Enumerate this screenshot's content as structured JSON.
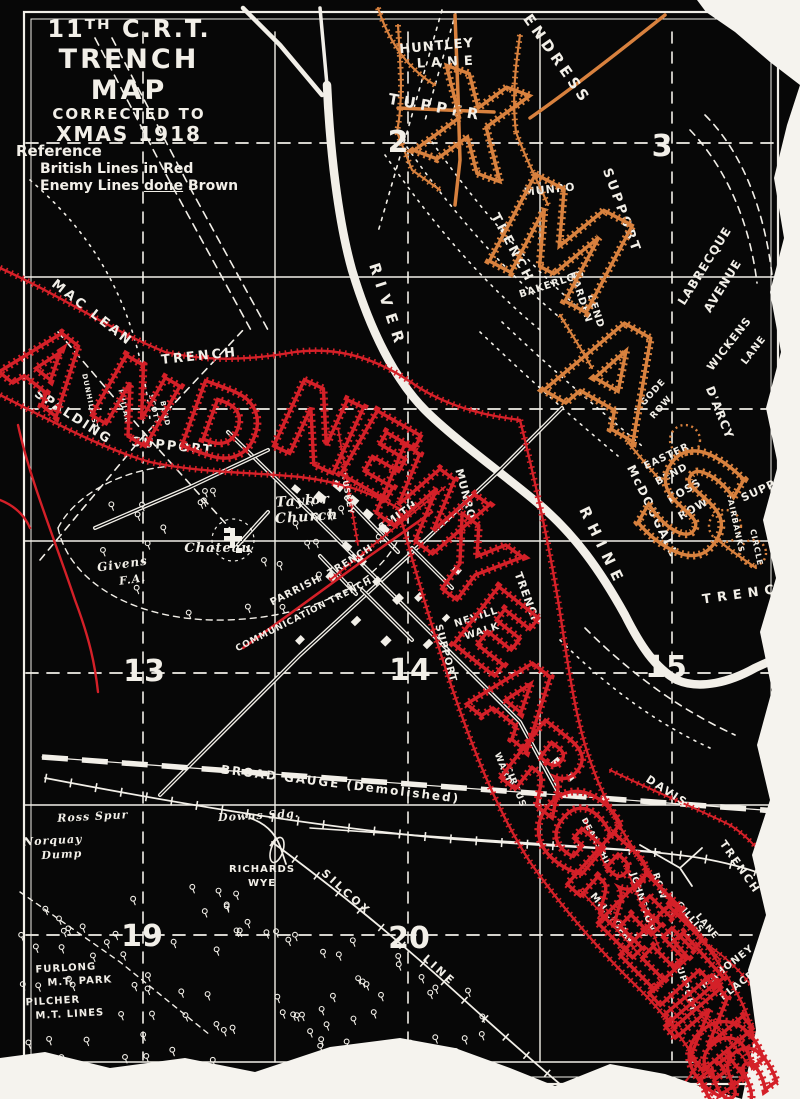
{
  "map_title": {
    "line1": "11ᵀᴴ C.R.T.",
    "line2": "TRENCH MAP",
    "line3": "CORRECTED TO",
    "line4": "XMAS 1918"
  },
  "reference": {
    "heading": "Reference",
    "british_line": "British Lines in Red",
    "enemy_pre": "Enemy Lines ",
    "enemy_underlined": "done",
    "enemy_post": " Brown"
  },
  "colors": {
    "british_red": "#d42028",
    "enemy_brown": "#d8813e",
    "map_black": "#070707",
    "line_white": "#f2efe8",
    "paper_white": "#f5f3ee"
  },
  "greetings": {
    "red_text": "AND NEW YEAR GREETINGS",
    "brown_text": "XMAS"
  },
  "big_letters": [
    {
      "ch": "A",
      "x": 48,
      "y": 368,
      "r": 38,
      "s": 95,
      "c": "red"
    },
    {
      "ch": "N",
      "x": 135,
      "y": 402,
      "r": 30,
      "s": 95,
      "c": "red"
    },
    {
      "ch": "D",
      "x": 222,
      "y": 425,
      "r": 20,
      "s": 95,
      "c": "red"
    },
    {
      "ch": "N",
      "x": 318,
      "y": 428,
      "r": 25,
      "s": 100,
      "c": "red"
    },
    {
      "ch": "E",
      "x": 380,
      "y": 456,
      "r": 30,
      "s": 100,
      "c": "red"
    },
    {
      "ch": "W",
      "x": 425,
      "y": 505,
      "r": 36,
      "s": 100,
      "c": "red"
    },
    {
      "ch": "Y",
      "x": 470,
      "y": 566,
      "r": 36,
      "s": 100,
      "c": "red"
    },
    {
      "ch": "E",
      "x": 495,
      "y": 632,
      "r": 38,
      "s": 100,
      "c": "red"
    },
    {
      "ch": "A",
      "x": 518,
      "y": 700,
      "r": 38,
      "s": 100,
      "c": "red"
    },
    {
      "ch": "R",
      "x": 545,
      "y": 768,
      "r": 38,
      "s": 100,
      "c": "red"
    },
    {
      "ch": "G",
      "x": 575,
      "y": 830,
      "r": 40,
      "s": 100,
      "c": "red"
    },
    {
      "ch": "R",
      "x": 610,
      "y": 878,
      "r": 42,
      "s": 95,
      "c": "red"
    },
    {
      "ch": "E",
      "x": 638,
      "y": 916,
      "r": 45,
      "s": 95,
      "c": "red"
    },
    {
      "ch": "E",
      "x": 660,
      "y": 948,
      "r": 45,
      "s": 95,
      "c": "red"
    },
    {
      "ch": "T",
      "x": 678,
      "y": 978,
      "r": 48,
      "s": 90,
      "c": "red"
    },
    {
      "ch": "I",
      "x": 692,
      "y": 1002,
      "r": 50,
      "s": 85,
      "c": "red"
    },
    {
      "ch": "N",
      "x": 708,
      "y": 1028,
      "r": 50,
      "s": 90,
      "c": "red"
    },
    {
      "ch": "G",
      "x": 722,
      "y": 1056,
      "r": 52,
      "s": 90,
      "c": "red"
    },
    {
      "ch": "S",
      "x": 738,
      "y": 1082,
      "r": 55,
      "s": 90,
      "c": "red"
    },
    {
      "ch": "X",
      "x": 472,
      "y": 125,
      "r": 20,
      "s": 125,
      "c": "brown"
    },
    {
      "ch": "M",
      "x": 560,
      "y": 245,
      "r": 28,
      "s": 135,
      "c": "brown"
    },
    {
      "ch": "A",
      "x": 612,
      "y": 375,
      "r": 30,
      "s": 135,
      "c": "brown"
    },
    {
      "ch": "S",
      "x": 692,
      "y": 505,
      "r": 30,
      "s": 135,
      "c": "brown"
    }
  ],
  "grid_numbers": [
    {
      "t": "2",
      "x": 398,
      "y": 152
    },
    {
      "t": "3",
      "x": 662,
      "y": 156
    },
    {
      "t": "13",
      "x": 144,
      "y": 681
    },
    {
      "t": "14",
      "x": 410,
      "y": 680
    },
    {
      "t": "15",
      "x": 666,
      "y": 677
    },
    {
      "t": "19",
      "x": 142,
      "y": 946
    },
    {
      "t": "20",
      "x": 409,
      "y": 948
    }
  ],
  "labels": [
    {
      "t": "HUNTLEY",
      "x": 437,
      "y": 50,
      "r": -5,
      "s": 13
    },
    {
      "t": "LANE",
      "x": 448,
      "y": 66,
      "r": -3,
      "s": 13,
      "sp": 6
    },
    {
      "t": "ENDRESS",
      "x": 553,
      "y": 62,
      "r": 55,
      "s": 15,
      "sp": 4
    },
    {
      "t": "TUPPER",
      "x": 435,
      "y": 112,
      "r": 10,
      "s": 15,
      "sp": 5
    },
    {
      "t": "BAKERLOO",
      "x": 553,
      "y": 287,
      "r": -18,
      "s": 10
    },
    {
      "t": "MUNRO",
      "x": 550,
      "y": 193,
      "r": -6,
      "s": 11
    },
    {
      "t": "SUPPORT",
      "x": 618,
      "y": 212,
      "r": 70,
      "s": 13,
      "sp": 3
    },
    {
      "t": "TRENCH",
      "x": 509,
      "y": 250,
      "r": 62,
      "s": 13,
      "sp": 3
    },
    {
      "t": "HARDEN",
      "x": 578,
      "y": 298,
      "r": 72,
      "s": 10
    },
    {
      "t": "BEND",
      "x": 593,
      "y": 312,
      "r": 72,
      "s": 10
    },
    {
      "t": "LABRECQUE",
      "x": 708,
      "y": 268,
      "r": -58,
      "s": 12
    },
    {
      "t": "AVENUE",
      "x": 726,
      "y": 288,
      "r": -58,
      "s": 12
    },
    {
      "t": "WICKENS",
      "x": 732,
      "y": 346,
      "r": -52,
      "s": 11
    },
    {
      "t": "LANE",
      "x": 756,
      "y": 352,
      "r": -52,
      "s": 10
    },
    {
      "t": "D'ARCY",
      "x": 716,
      "y": 414,
      "r": 68,
      "s": 12
    },
    {
      "t": "GODE",
      "x": 655,
      "y": 394,
      "r": -48,
      "s": 9
    },
    {
      "t": "ROW",
      "x": 663,
      "y": 409,
      "r": -48,
      "s": 9
    },
    {
      "t": "EASTER",
      "x": 668,
      "y": 459,
      "r": -25,
      "s": 10
    },
    {
      "t": "BEND",
      "x": 673,
      "y": 477,
      "r": -28,
      "s": 10
    },
    {
      "t": "ROSS",
      "x": 686,
      "y": 494,
      "r": -30,
      "s": 11
    },
    {
      "t": "ROW",
      "x": 695,
      "y": 512,
      "r": -30,
      "s": 11
    },
    {
      "t": "McDOUGALL",
      "x": 649,
      "y": 513,
      "r": 64,
      "s": 12,
      "sp": 2
    },
    {
      "t": "SUPP",
      "x": 760,
      "y": 494,
      "r": -25,
      "s": 11
    },
    {
      "t": "FAIRBANKS",
      "x": 733,
      "y": 524,
      "r": 78,
      "s": 8
    },
    {
      "t": "CIRCLE",
      "x": 754,
      "y": 548,
      "r": 78,
      "s": 8
    },
    {
      "t": "TRENCH",
      "x": 750,
      "y": 597,
      "r": -8,
      "s": 13,
      "sp": 6
    },
    {
      "t": "RIVER",
      "x": 383,
      "y": 308,
      "r": 72,
      "s": 15,
      "sp": 8
    },
    {
      "t": "RHINE",
      "x": 598,
      "y": 549,
      "r": 64,
      "s": 15,
      "sp": 7
    },
    {
      "t": "MAC LEAN",
      "x": 90,
      "y": 316,
      "r": 38,
      "s": 13,
      "sp": 3
    },
    {
      "t": "TRENCH",
      "x": 200,
      "y": 360,
      "r": -6,
      "s": 13,
      "sp": 3
    },
    {
      "t": "SPALDING",
      "x": 71,
      "y": 420,
      "r": 33,
      "s": 13,
      "sp": 2
    },
    {
      "t": "SUPPORT",
      "x": 172,
      "y": 450,
      "r": 6,
      "s": 13,
      "sp": 2
    },
    {
      "t": "DUNHILL ST",
      "x": 88,
      "y": 402,
      "r": 78,
      "s": 7
    },
    {
      "t": "PHILAN",
      "x": 122,
      "y": 407,
      "r": 78,
      "s": 7
    },
    {
      "t": "SCOTT",
      "x": 152,
      "y": 410,
      "r": 78,
      "s": 7
    },
    {
      "t": "BEND",
      "x": 163,
      "y": 414,
      "r": 78,
      "s": 7
    },
    {
      "t": "Taylor",
      "x": 303,
      "y": 505,
      "r": -4,
      "s": 14,
      "st": "script"
    },
    {
      "t": "Church",
      "x": 307,
      "y": 521,
      "r": -4,
      "s": 14,
      "st": "script"
    },
    {
      "t": "Chateau",
      "x": 218,
      "y": 552,
      "r": 0,
      "s": 13,
      "st": "script"
    },
    {
      "t": "Givens",
      "x": 123,
      "y": 568,
      "r": -8,
      "s": 12,
      "st": "script"
    },
    {
      "t": "F.A.",
      "x": 133,
      "y": 583,
      "r": -8,
      "s": 11,
      "st": "script"
    },
    {
      "t": "PARRISH",
      "x": 297,
      "y": 593,
      "r": -27,
      "s": 10
    },
    {
      "t": "COMMUNICATION TRENCH",
      "x": 305,
      "y": 617,
      "r": -27,
      "s": 9
    },
    {
      "t": "HUSKEY",
      "x": 345,
      "y": 494,
      "r": 80,
      "s": 8
    },
    {
      "t": "SMITH",
      "x": 400,
      "y": 519,
      "r": -35,
      "s": 11
    },
    {
      "t": "TRENCH",
      "x": 352,
      "y": 563,
      "r": -32,
      "s": 10
    },
    {
      "t": "MUNRO",
      "x": 462,
      "y": 495,
      "r": 75,
      "s": 11
    },
    {
      "t": "NEVILL",
      "x": 477,
      "y": 620,
      "r": -18,
      "s": 10
    },
    {
      "t": "WALK",
      "x": 483,
      "y": 634,
      "r": -18,
      "s": 10
    },
    {
      "t": "SUPPORT",
      "x": 443,
      "y": 654,
      "r": 75,
      "s": 10
    },
    {
      "t": "TRENCH",
      "x": 524,
      "y": 600,
      "r": 70,
      "s": 11
    },
    {
      "t": "WARD",
      "x": 501,
      "y": 770,
      "r": 68,
      "s": 9
    },
    {
      "t": "CIRCUS",
      "x": 513,
      "y": 788,
      "r": 68,
      "s": 9
    },
    {
      "t": "BROAD GAUGE (Demolished)",
      "x": 340,
      "y": 788,
      "r": 7,
      "s": 12,
      "sp": 2
    },
    {
      "t": "Ross Spur",
      "x": 93,
      "y": 820,
      "r": -3,
      "s": 11,
      "st": "script"
    },
    {
      "t": "Downs Sdg.",
      "x": 259,
      "y": 819,
      "r": -3,
      "s": 11,
      "st": "script"
    },
    {
      "t": "Norquay",
      "x": 53,
      "y": 844,
      "r": -3,
      "s": 11,
      "st": "script"
    },
    {
      "t": "Dump",
      "x": 62,
      "y": 858,
      "r": -3,
      "s": 11,
      "st": "script"
    },
    {
      "t": "RICHARDS",
      "x": 262,
      "y": 872,
      "r": 0,
      "s": 10
    },
    {
      "t": "WYE",
      "x": 262,
      "y": 886,
      "r": 0,
      "s": 10
    },
    {
      "t": "SILCOX",
      "x": 344,
      "y": 895,
      "r": 42,
      "s": 11,
      "sp": 3
    },
    {
      "t": "LINE",
      "x": 437,
      "y": 973,
      "r": 42,
      "s": 11,
      "sp": 3
    },
    {
      "t": "DAVIS",
      "x": 665,
      "y": 794,
      "r": 33,
      "s": 11,
      "sp": 2
    },
    {
      "t": "TRENCH",
      "x": 737,
      "y": 869,
      "r": 55,
      "s": 11,
      "sp": 2
    },
    {
      "t": "DEANS HL",
      "x": 594,
      "y": 843,
      "r": 62,
      "s": 8
    },
    {
      "t": "JOHNSTON",
      "x": 640,
      "y": 903,
      "r": 72,
      "s": 9
    },
    {
      "t": "ROW",
      "x": 657,
      "y": 887,
      "r": 72,
      "s": 9
    },
    {
      "t": "MILLIGAN",
      "x": 610,
      "y": 920,
      "r": 50,
      "s": 10
    },
    {
      "t": "GILLIS",
      "x": 688,
      "y": 919,
      "r": 50,
      "s": 9
    },
    {
      "t": "LANE",
      "x": 705,
      "y": 928,
      "r": 50,
      "s": 9
    },
    {
      "t": "SUPPORT",
      "x": 683,
      "y": 987,
      "r": 72,
      "s": 9
    },
    {
      "t": "MAHONEY",
      "x": 729,
      "y": 969,
      "r": -38,
      "s": 10
    },
    {
      "t": "PLACE",
      "x": 739,
      "y": 988,
      "r": -38,
      "s": 10
    },
    {
      "t": "FURLONG",
      "x": 66,
      "y": 971,
      "r": -3,
      "s": 10
    },
    {
      "t": "M.T. PARK",
      "x": 80,
      "y": 984,
      "r": -3,
      "s": 10
    },
    {
      "t": "PILCHER",
      "x": 53,
      "y": 1004,
      "r": -3,
      "s": 10
    },
    {
      "t": "M.T. LINES",
      "x": 70,
      "y": 1017,
      "r": -3,
      "s": 10
    }
  ]
}
